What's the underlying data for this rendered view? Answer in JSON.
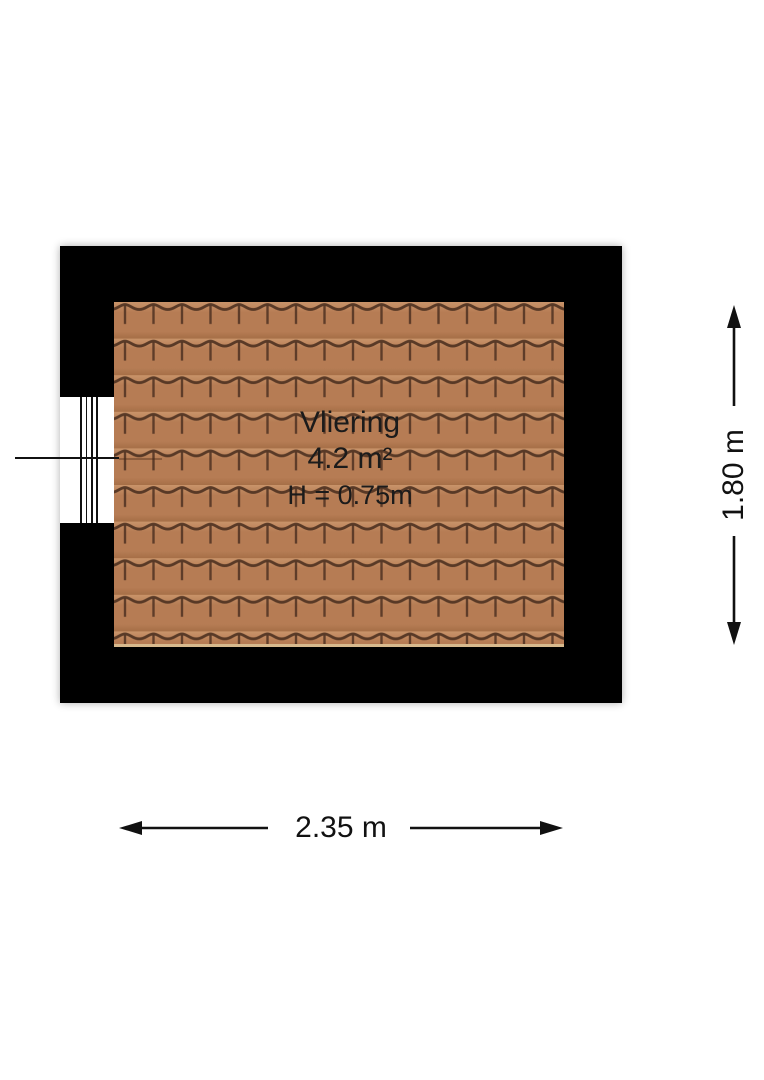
{
  "floorplan": {
    "room": {
      "name": "Vliering",
      "area": "4.2 m²",
      "height_clearance": "H = 0.75m"
    },
    "dimensions": {
      "width_label": "2.35 m",
      "height_label": "1.80 m"
    },
    "icons": {
      "width_arrow": "double-headed-horizontal-arrow",
      "height_arrow": "double-headed-vertical-arrow"
    },
    "colors": {
      "wall": "#000000",
      "tile_base": "#b67c54",
      "tile_base_light": "#c9946a",
      "tile_base_dark": "#a66f47",
      "tile_line": "#4e3120",
      "tile_bottom_edge": "#d7b98d",
      "text": "#1b1b1b",
      "background": "#ffffff"
    }
  }
}
